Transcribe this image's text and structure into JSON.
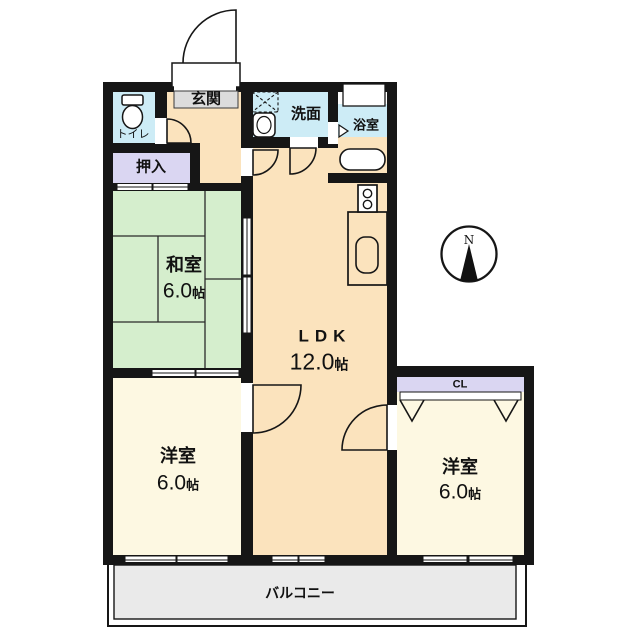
{
  "floorplan": {
    "rooms": {
      "entrance": {
        "label": "玄関"
      },
      "toilet": {
        "label": "トイレ"
      },
      "oshiire": {
        "label": "押入"
      },
      "washroom": {
        "label": "洗面"
      },
      "bathroom": {
        "label": "浴室"
      },
      "japanese_room": {
        "label": "和室",
        "size_value": "6.0",
        "size_unit": "帖"
      },
      "ldk": {
        "label": "LDK",
        "size_value": "12.0",
        "size_unit": "帖"
      },
      "western_room_left": {
        "label": "洋室",
        "size_value": "6.0",
        "size_unit": "帖"
      },
      "western_room_right": {
        "label": "洋室",
        "size_value": "6.0",
        "size_unit": "帖"
      },
      "closet_cl": {
        "label": "CL"
      },
      "balcony": {
        "label": "バルコニー"
      }
    },
    "compass": {
      "north": "N"
    },
    "colors": {
      "wall": "#161616",
      "ldk_fill": "#fbe3bd",
      "tatami_fill": "#d5eecd",
      "western_fill": "#fdf8e2",
      "wet_area_fill": "#cdecf6",
      "closet_fill": "#dad6f2",
      "entrance_fill": "#dcdcdc",
      "balcony_fill": "#eaeaea"
    }
  }
}
